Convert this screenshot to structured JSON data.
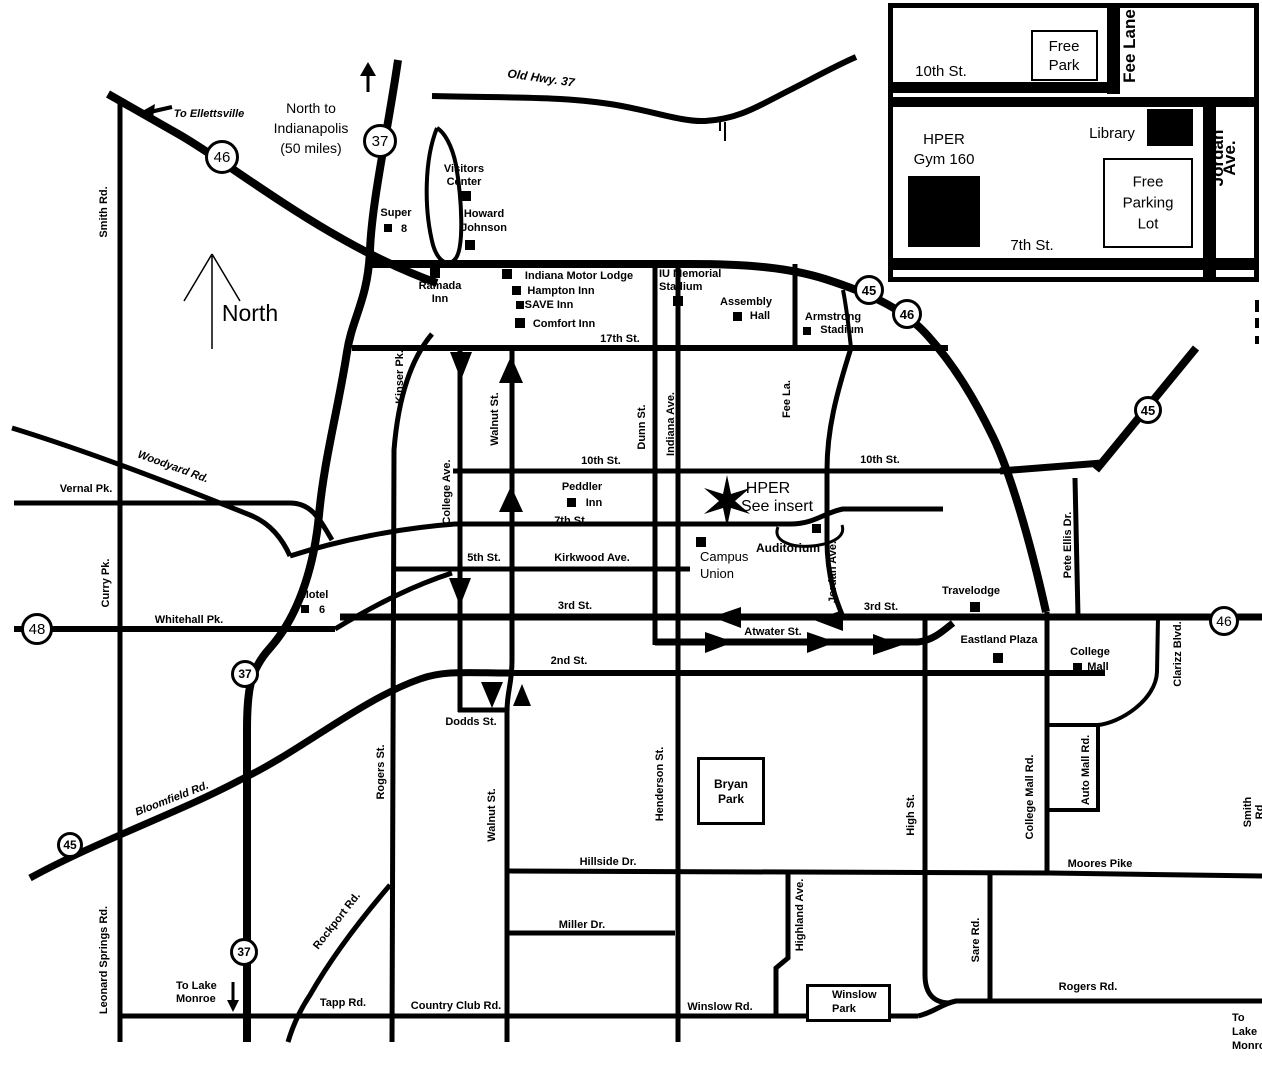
{
  "labels": [
    {
      "id": "to-ellettsville",
      "text": "To Ellettsville",
      "x": 209,
      "y": 114,
      "italic": true
    },
    {
      "id": "north-to-indianapolis",
      "text": "North to\nIndianapolis\n(50 miles)",
      "x": 311,
      "y": 128,
      "size": 14,
      "bold": false,
      "lh": 20
    },
    {
      "id": "north",
      "text": "North",
      "x": 250,
      "y": 313,
      "size": 23,
      "bold": false
    },
    {
      "id": "smith-rd-west",
      "text": "Smith Rd.",
      "x": 104,
      "y": 212,
      "rot": -90
    },
    {
      "id": "old-hwy-37",
      "text": "Old Hwy. 37",
      "x": 541,
      "y": 78,
      "size": 12,
      "italic": true,
      "rot": 8
    },
    {
      "id": "super",
      "text": "Super",
      "x": 396,
      "y": 213
    },
    {
      "id": "super-8-number",
      "text": "8",
      "x": 404,
      "y": 229
    },
    {
      "id": "visitors-center",
      "text": "Visitors\nCenter",
      "x": 464,
      "y": 176,
      "lh": 13
    },
    {
      "id": "howard-johnson",
      "text": "Howard\nJohnson",
      "x": 484,
      "y": 221,
      "lh": 14
    },
    {
      "id": "ramada-inn",
      "text": "Ramada\nInn",
      "x": 440,
      "y": 293,
      "lh": 13
    },
    {
      "id": "indiana-motor-lodge",
      "text": "Indiana Motor Lodge",
      "x": 579,
      "y": 276
    },
    {
      "id": "hampton-inn",
      "text": "Hampton Inn",
      "x": 561,
      "y": 291
    },
    {
      "id": "save-inn",
      "text": "SAVE Inn",
      "x": 549,
      "y": 305
    },
    {
      "id": "comfort-inn",
      "text": "Comfort Inn",
      "x": 564,
      "y": 324
    },
    {
      "id": "iu-memorial-stadium",
      "text": "IU Memorial\nStadium",
      "x": 659,
      "y": 281,
      "align": "left",
      "lh": 13
    },
    {
      "id": "assembly",
      "text": "Assembly",
      "x": 746,
      "y": 302
    },
    {
      "id": "assembly-hall",
      "text": "Hall",
      "x": 760,
      "y": 316
    },
    {
      "id": "armstrong",
      "text": "Armstrong",
      "x": 833,
      "y": 317
    },
    {
      "id": "armstrong-stadium",
      "text": "Stadium",
      "x": 842,
      "y": 330
    },
    {
      "id": "17th-st",
      "text": "17th St.",
      "x": 620,
      "y": 339
    },
    {
      "id": "kinser-pk",
      "text": "Kinser Pk.",
      "x": 400,
      "y": 377,
      "rot": -90
    },
    {
      "id": "walnut-st-north",
      "text": "Walnut St.",
      "x": 495,
      "y": 419,
      "rot": -90
    },
    {
      "id": "college-ave",
      "text": "College Ave.",
      "x": 447,
      "y": 492,
      "rot": -90
    },
    {
      "id": "dunn-st",
      "text": "Dunn St.",
      "x": 642,
      "y": 427,
      "rot": -90
    },
    {
      "id": "indiana-ave",
      "text": "Indiana Ave.",
      "x": 671,
      "y": 424,
      "rot": -90
    },
    {
      "id": "fee-la",
      "text": "Fee La.",
      "x": 787,
      "y": 399,
      "rot": -90
    },
    {
      "id": "10th-st-west",
      "text": "10th St.",
      "x": 601,
      "y": 461
    },
    {
      "id": "10th-st-east",
      "text": "10th St.",
      "x": 880,
      "y": 460
    },
    {
      "id": "peddler",
      "text": "Peddler",
      "x": 582,
      "y": 487
    },
    {
      "id": "peddler-inn",
      "text": "Inn",
      "x": 594,
      "y": 503
    },
    {
      "id": "7th-st-small",
      "text": "7th St.",
      "x": 571,
      "y": 521
    },
    {
      "id": "hper",
      "text": "HPER",
      "x": 768,
      "y": 489,
      "size": 16,
      "bold": false
    },
    {
      "id": "see-insert",
      "text": "See insert",
      "x": 777,
      "y": 507,
      "size": 16,
      "bold": false
    },
    {
      "id": "campus-union",
      "text": "Campus\nUnion",
      "x": 700,
      "y": 565,
      "size": 13,
      "bold": false,
      "align": "left",
      "lh": 17
    },
    {
      "id": "auditorium",
      "text": "Auditorium",
      "x": 788,
      "y": 548,
      "size": 12
    },
    {
      "id": "jordan-ave-map",
      "text": "Jordan Ave.",
      "x": 833,
      "y": 572,
      "rot": -90
    },
    {
      "id": "kirkwood-ave",
      "text": "Kirkwood Ave.",
      "x": 592,
      "y": 558
    },
    {
      "id": "5th-st",
      "text": "5th St.",
      "x": 484,
      "y": 558
    },
    {
      "id": "vernal-pk",
      "text": "Vernal Pk.",
      "x": 86,
      "y": 489
    },
    {
      "id": "woodyard-rd",
      "text": "Woodyard Rd.",
      "x": 173,
      "y": 467,
      "italic": true,
      "rot": 20
    },
    {
      "id": "curry-pk",
      "text": "Curry Pk.",
      "x": 106,
      "y": 583,
      "rot": -90
    },
    {
      "id": "whitehall-pk",
      "text": "Whitehall Pk.",
      "x": 189,
      "y": 620
    },
    {
      "id": "motel",
      "text": "Motel",
      "x": 314,
      "y": 595
    },
    {
      "id": "motel-6-number",
      "text": "6",
      "x": 322,
      "y": 610
    },
    {
      "id": "3rd-st-west",
      "text": "3rd St.",
      "x": 575,
      "y": 606
    },
    {
      "id": "3rd-st-east",
      "text": "3rd St.",
      "x": 881,
      "y": 607
    },
    {
      "id": "atwater-st",
      "text": "Atwater St.",
      "x": 773,
      "y": 632
    },
    {
      "id": "2nd-st",
      "text": "2nd St.",
      "x": 569,
      "y": 661
    },
    {
      "id": "travelodge",
      "text": "Travelodge",
      "x": 971,
      "y": 591
    },
    {
      "id": "eastland-plaza",
      "text": "Eastland Plaza",
      "x": 999,
      "y": 640
    },
    {
      "id": "college-mall",
      "text": "College",
      "x": 1090,
      "y": 652
    },
    {
      "id": "college-mall-2",
      "text": "Mall",
      "x": 1098,
      "y": 667
    },
    {
      "id": "pete-ellis-dr",
      "text": "Pete Ellis Dr.",
      "x": 1068,
      "y": 545,
      "rot": -90
    },
    {
      "id": "clarizz-blvd",
      "text": "Clarizz Blvd.",
      "x": 1178,
      "y": 654,
      "rot": -90
    },
    {
      "id": "dodds-st",
      "text": "Dodds St.",
      "x": 471,
      "y": 722
    },
    {
      "id": "rogers-st",
      "text": "Rogers St.",
      "x": 381,
      "y": 772,
      "rot": -90
    },
    {
      "id": "walnut-st-south",
      "text": "Walnut St.",
      "x": 492,
      "y": 815,
      "rot": -90
    },
    {
      "id": "henderson-st",
      "text": "Henderson St.",
      "x": 660,
      "y": 784,
      "rot": -90
    },
    {
      "id": "high-st",
      "text": "High St.",
      "x": 911,
      "y": 815,
      "rot": -90
    },
    {
      "id": "bryan-park",
      "text": "Bryan\nPark",
      "x": 731,
      "y": 792,
      "size": 12,
      "lh": 15
    },
    {
      "id": "hillside-dr",
      "text": "Hillside Dr.",
      "x": 608,
      "y": 862
    },
    {
      "id": "miller-dr",
      "text": "Miller Dr.",
      "x": 582,
      "y": 925
    },
    {
      "id": "highland-ave",
      "text": "Highland Ave.",
      "x": 800,
      "y": 915,
      "rot": -90
    },
    {
      "id": "college-mall-rd",
      "text": "College Mall Rd.",
      "x": 1030,
      "y": 797,
      "rot": -90
    },
    {
      "id": "auto-mall-rd",
      "text": "Auto Mall Rd.",
      "x": 1086,
      "y": 770,
      "rot": -90
    },
    {
      "id": "moores-pike",
      "text": "Moores Pike",
      "x": 1100,
      "y": 864
    },
    {
      "id": "sare-rd",
      "text": "Sare Rd.",
      "x": 976,
      "y": 940,
      "rot": -90
    },
    {
      "id": "bloomfield-rd",
      "text": "Bloomfield Rd.",
      "x": 172,
      "y": 799,
      "italic": true,
      "rot": -21
    },
    {
      "id": "rockport-rd",
      "text": "Rockport Rd.",
      "x": 337,
      "y": 921,
      "rot": -52
    },
    {
      "id": "leonard-springs-rd",
      "text": "Leonard Springs Rd.",
      "x": 104,
      "y": 960,
      "rot": -90
    },
    {
      "id": "to-lake-monroe",
      "text": "To Lake\nMonroe",
      "x": 176,
      "y": 993,
      "align": "left",
      "lh": 13
    },
    {
      "id": "tapp-rd",
      "text": "Tapp Rd.",
      "x": 343,
      "y": 1003
    },
    {
      "id": "country-club-rd",
      "text": "Country Club Rd.",
      "x": 456,
      "y": 1006
    },
    {
      "id": "winslow-rd",
      "text": "Winslow Rd.",
      "x": 720,
      "y": 1007
    },
    {
      "id": "winslow-park",
      "text": "Winslow\nPark",
      "x": 832,
      "y": 1002,
      "align": "left",
      "lh": 14
    },
    {
      "id": "rogers-rd",
      "text": "Rogers Rd.",
      "x": 1088,
      "y": 987
    },
    {
      "id": "smith-rd-east",
      "text": "Smith Rd",
      "x": 1254,
      "y": 812,
      "rot": -90
    },
    {
      "id": "to-lake-monroe-se",
      "text": "To Lake\nMonroe",
      "x": 1232,
      "y": 1032,
      "align": "left",
      "lh": 14
    },
    {
      "id": "inset-10th-st",
      "text": "10th St.",
      "x": 941,
      "y": 72,
      "size": 15,
      "bold": false
    },
    {
      "id": "inset-free-park",
      "text": "Free\nPark",
      "x": 1064,
      "y": 56,
      "size": 15,
      "bold": false,
      "lh": 19
    },
    {
      "id": "inset-fee-lane",
      "text": "Fee Lane",
      "x": 1130,
      "y": 46,
      "size": 17,
      "rot": -90
    },
    {
      "id": "inset-jordan-ave",
      "text": "Jordan Ave.",
      "x": 1224,
      "y": 158,
      "size": 17,
      "rot": -90
    },
    {
      "id": "inset-hper-gym",
      "text": "HPER\nGym 160",
      "x": 944,
      "y": 150,
      "size": 15,
      "bold": false,
      "lh": 20
    },
    {
      "id": "inset-library",
      "text": "Library",
      "x": 1112,
      "y": 134,
      "size": 15,
      "bold": false
    },
    {
      "id": "inset-free-parking-lot",
      "text": "Free\nParking\nLot",
      "x": 1148,
      "y": 203,
      "size": 15,
      "bold": false,
      "lh": 21
    },
    {
      "id": "inset-7th-st",
      "text": "7th St.",
      "x": 1032,
      "y": 246,
      "size": 15,
      "bold": false
    }
  ],
  "shields": [
    {
      "num": "46",
      "x": 222,
      "y": 157,
      "r": 17,
      "fs": 15,
      "fw": 400
    },
    {
      "num": "37",
      "x": 380,
      "y": 141,
      "r": 17,
      "fs": 15,
      "fw": 400
    },
    {
      "num": "45",
      "x": 869,
      "y": 290,
      "r": 15,
      "fs": 13,
      "fw": 700
    },
    {
      "num": "46",
      "x": 907,
      "y": 314,
      "r": 15,
      "fs": 13,
      "fw": 700
    },
    {
      "num": "45",
      "x": 1148,
      "y": 410,
      "r": 14,
      "fs": 13,
      "fw": 700
    },
    {
      "num": "48",
      "x": 37,
      "y": 629,
      "r": 16,
      "fs": 15,
      "fw": 400
    },
    {
      "num": "46",
      "x": 1224,
      "y": 621,
      "r": 15,
      "fs": 14,
      "fw": 400
    },
    {
      "num": "37",
      "x": 245,
      "y": 674,
      "r": 14,
      "fs": 12,
      "fw": 700
    },
    {
      "num": "45",
      "x": 70,
      "y": 845,
      "r": 13,
      "fs": 12,
      "fw": 700
    },
    {
      "num": "37",
      "x": 244,
      "y": 952,
      "r": 14,
      "fs": 12,
      "fw": 700
    }
  ],
  "markers": [
    {
      "id": "super-8",
      "x": 388,
      "y": 228,
      "w": 8,
      "h": 8
    },
    {
      "id": "visitors-center",
      "x": 466,
      "y": 196,
      "w": 10,
      "h": 10
    },
    {
      "id": "howard-johnson",
      "x": 470,
      "y": 245,
      "w": 10,
      "h": 10
    },
    {
      "id": "ramada-inn",
      "x": 435,
      "y": 273,
      "w": 10,
      "h": 10
    },
    {
      "id": "indiana-motor-lodge",
      "x": 507,
      "y": 274,
      "w": 10,
      "h": 10
    },
    {
      "id": "hampton-inn",
      "x": 516,
      "y": 290,
      "w": 9,
      "h": 9
    },
    {
      "id": "save-inn",
      "x": 520,
      "y": 305,
      "w": 8,
      "h": 8
    },
    {
      "id": "comfort-inn",
      "x": 520,
      "y": 323,
      "w": 10,
      "h": 10
    },
    {
      "id": "iu-memorial-stadium",
      "x": 678,
      "y": 301,
      "w": 10,
      "h": 10
    },
    {
      "id": "assembly-hall",
      "x": 737,
      "y": 316,
      "w": 9,
      "h": 9
    },
    {
      "id": "armstrong-stadium",
      "x": 807,
      "y": 331,
      "w": 8,
      "h": 8
    },
    {
      "id": "peddler-inn",
      "x": 571,
      "y": 502,
      "w": 9,
      "h": 9
    },
    {
      "id": "campus-union",
      "x": 701,
      "y": 542,
      "w": 10,
      "h": 10
    },
    {
      "id": "auditorium",
      "x": 816,
      "y": 528,
      "w": 9,
      "h": 9
    },
    {
      "id": "motel-6",
      "x": 305,
      "y": 609,
      "w": 8,
      "h": 8
    },
    {
      "id": "travelodge",
      "x": 975,
      "y": 607,
      "w": 10,
      "h": 10
    },
    {
      "id": "eastland-plaza",
      "x": 998,
      "y": 658,
      "w": 10,
      "h": 10
    },
    {
      "id": "college-mall",
      "x": 1077,
      "y": 667,
      "w": 9,
      "h": 9
    },
    {
      "id": "inset-library-building",
      "x": 1170,
      "y": 127,
      "w": 46,
      "h": 37
    },
    {
      "id": "inset-hper-building",
      "x": 944,
      "y": 211,
      "w": 72,
      "h": 71
    }
  ],
  "white_boxes": [
    {
      "id": "inset-free-park-box",
      "x": 1031,
      "y": 30,
      "w": 67,
      "h": 51,
      "bw": 2
    },
    {
      "id": "inset-free-parking-lot-box",
      "x": 1103,
      "y": 158,
      "w": 90,
      "h": 90,
      "bw": 2
    },
    {
      "id": "bryan-park-box",
      "x": 697,
      "y": 757,
      "w": 68,
      "h": 68,
      "bw": 3
    },
    {
      "id": "winslow-park-box",
      "x": 806,
      "y": 984,
      "w": 85,
      "h": 38,
      "bw": 3
    }
  ]
}
